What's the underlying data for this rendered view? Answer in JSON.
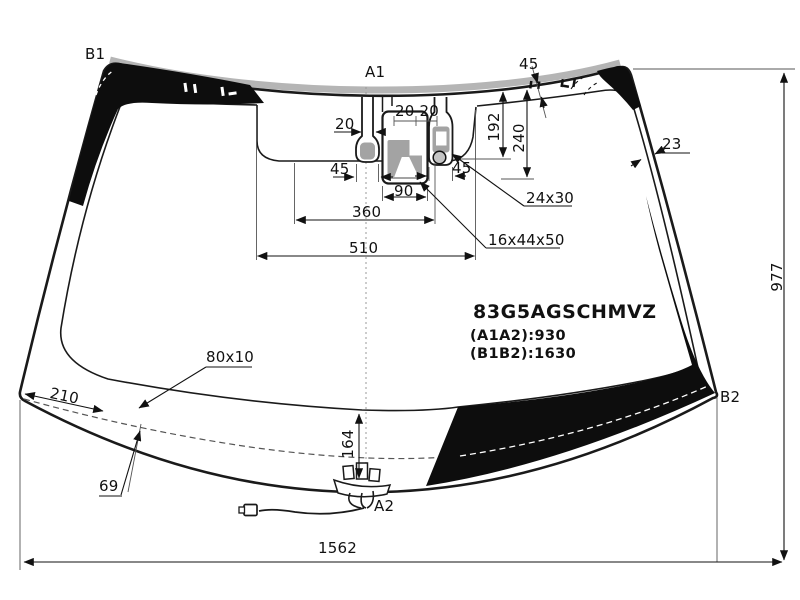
{
  "part_block": {
    "part_number": "83G5AGSCHMVZ",
    "a1a2": "(A1A2):930",
    "b1b2": "(B1B2):1630"
  },
  "points": {
    "b1": "B1",
    "a1": "A1",
    "a2": "A2",
    "b2": "B2"
  },
  "dims": {
    "top_band_width": "45",
    "neck_width": "20",
    "gaps": "20 20",
    "drop_192": "192",
    "drop_240": "240",
    "side_band_width": "23",
    "keyhole_width": "45",
    "sensor_width": "45",
    "camera_width": "90",
    "span_360": "360",
    "span_510": "510",
    "glass_height": "977",
    "glass_width": "1562",
    "pad_distance": "210",
    "pad_corner": "69",
    "wire_height": "164"
  },
  "callouts": {
    "pad_size": "80x10",
    "sensor_size": "24x30",
    "camera_size": "16x44x50"
  },
  "colors": {
    "line": "#1a1a1a",
    "molding": "#b5b5b5",
    "frit_band": "#0d0d0d",
    "sensor_fill": "#a3a3a3"
  }
}
